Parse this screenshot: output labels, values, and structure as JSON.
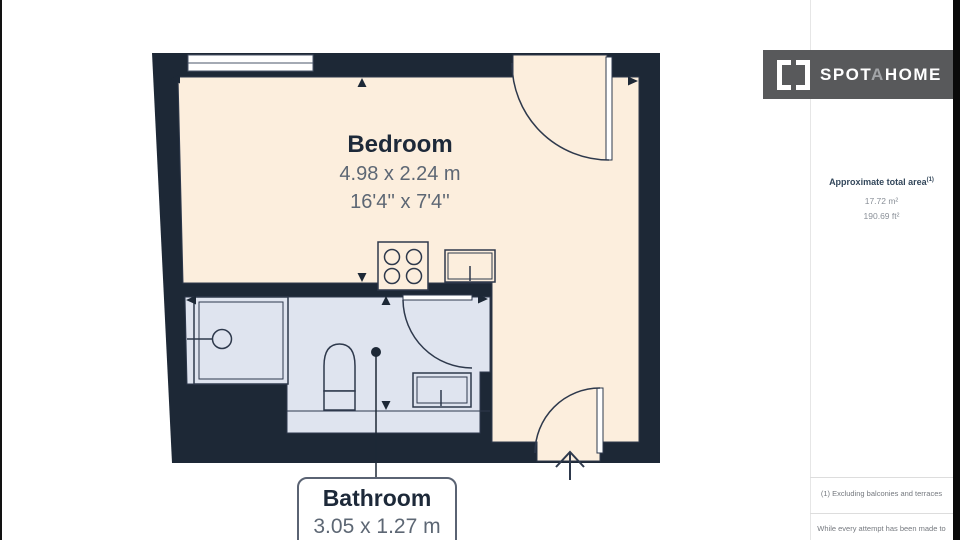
{
  "logo": {
    "prefix": "SPOT",
    "mid": "A",
    "suffix": "HOME"
  },
  "sidebar": {
    "area_heading": "Approximate total area",
    "area_heading_sup": "(1)",
    "area_m2": "17.72 m²",
    "area_ft2": "190.69 ft²",
    "note_exclusion": "(1) Excluding balconies and terraces",
    "note_disclaimer": "While every attempt has been made to"
  },
  "rooms": {
    "bedroom": {
      "name": "Bedroom",
      "dim_m": "4.98 x 2.24 m",
      "dim_ft": "16'4'' x 7'4''"
    },
    "bathroom": {
      "name": "Bathroom",
      "dim_m": "3.05 x 1.27 m"
    }
  },
  "colors": {
    "wall": "#1d2836",
    "bedroom_fill": "#fceedd",
    "bathroom_fill": "#dfe4ef",
    "outline": "#2e394c",
    "label_dark": "#1d2939",
    "label_gray": "#5d6774",
    "logo_background": "#58595b",
    "logo_mid_letter": "#a2a4a7"
  }
}
